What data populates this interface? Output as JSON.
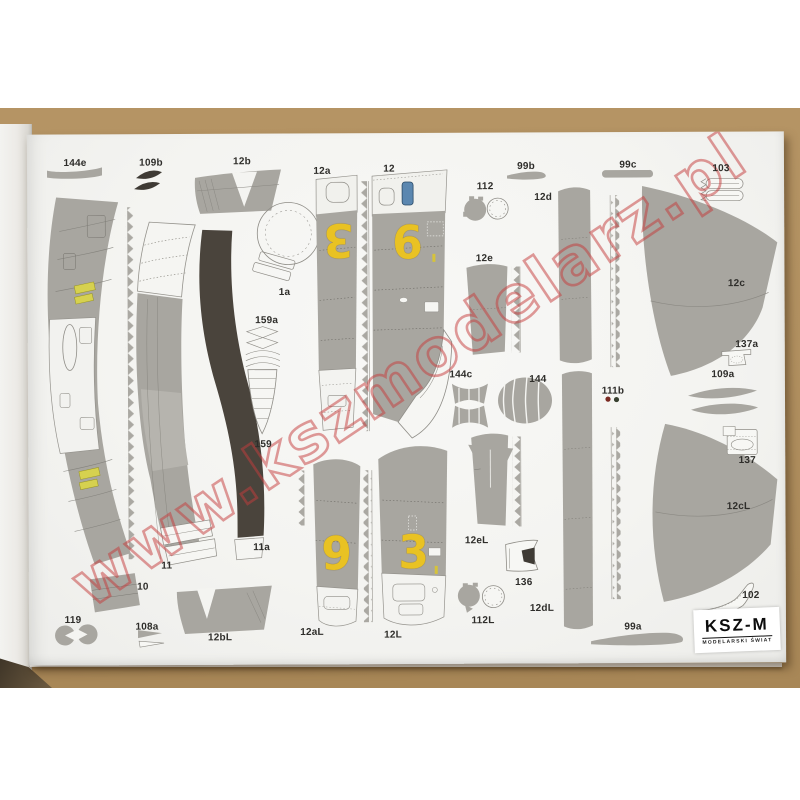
{
  "photo": {
    "description": "Paper model kit parts sheet photographed on cardboard backdrop",
    "watermark": "www.kszmodelarz.pl",
    "publisher": {
      "name": "KSZ-M",
      "tagline": "MODELARSKI ŚWIAT"
    },
    "sheet": {
      "labels": [
        {
          "label": "144e",
          "x": 76,
          "y": 162
        },
        {
          "label": "109b",
          "x": 152,
          "y": 162
        },
        {
          "label": "12b",
          "x": 243,
          "y": 161
        },
        {
          "label": "12a",
          "x": 323,
          "y": 171
        },
        {
          "label": "12",
          "x": 390,
          "y": 169
        },
        {
          "label": "99b",
          "x": 527,
          "y": 167
        },
        {
          "label": "112",
          "x": 486,
          "y": 187
        },
        {
          "label": "12d",
          "x": 544,
          "y": 198
        },
        {
          "label": "99c",
          "x": 629,
          "y": 166
        },
        {
          "label": "103",
          "x": 722,
          "y": 170
        },
        {
          "label": "1a",
          "x": 285,
          "y": 292
        },
        {
          "label": "12e",
          "x": 485,
          "y": 259
        },
        {
          "label": "12c",
          "x": 737,
          "y": 285
        },
        {
          "label": "159a",
          "x": 267,
          "y": 320
        },
        {
          "label": "159",
          "x": 263,
          "y": 444
        },
        {
          "label": "144c",
          "x": 461,
          "y": 375
        },
        {
          "label": "144",
          "x": 538,
          "y": 380
        },
        {
          "label": "111b",
          "x": 613,
          "y": 392
        },
        {
          "label": "137a",
          "x": 747,
          "y": 346
        },
        {
          "label": "109a",
          "x": 723,
          "y": 376
        },
        {
          "label": "137",
          "x": 747,
          "y": 462
        },
        {
          "label": "12eL",
          "x": 476,
          "y": 541
        },
        {
          "label": "136",
          "x": 523,
          "y": 583
        },
        {
          "label": "12cL",
          "x": 738,
          "y": 508
        },
        {
          "label": "11a",
          "x": 261,
          "y": 547
        },
        {
          "label": "11",
          "x": 166,
          "y": 565
        },
        {
          "label": "10",
          "x": 142,
          "y": 586
        },
        {
          "label": "119",
          "x": 72,
          "y": 619
        },
        {
          "label": "108a",
          "x": 146,
          "y": 626
        },
        {
          "label": "12bL",
          "x": 219,
          "y": 637
        },
        {
          "label": "12aL",
          "x": 311,
          "y": 632
        },
        {
          "label": "12L",
          "x": 392,
          "y": 635
        },
        {
          "label": "112L",
          "x": 482,
          "y": 621
        },
        {
          "label": "12dL",
          "x": 541,
          "y": 609
        },
        {
          "label": "99a",
          "x": 632,
          "y": 628
        },
        {
          "label": "102",
          "x": 750,
          "y": 597
        }
      ],
      "markings": [
        {
          "text": "3",
          "x": 339,
          "y": 240,
          "rot": 180
        },
        {
          "text": "9",
          "x": 408,
          "y": 241,
          "rot": 180
        },
        {
          "text": "9",
          "x": 336,
          "y": 553,
          "rot": 0
        },
        {
          "text": "3",
          "x": 413,
          "y": 552,
          "rot": 0
        }
      ]
    },
    "colors": {
      "cardboard": "#b19060",
      "page": "#f5f5f2",
      "part_gray": "#a8a6a0",
      "dark_band": "#4a443c",
      "marking_yellow": "#e9c223",
      "detail_yellow": "#d6d14f",
      "watermark_red": "#c53c3c",
      "canopy_blue": "#5b87b0"
    }
  }
}
